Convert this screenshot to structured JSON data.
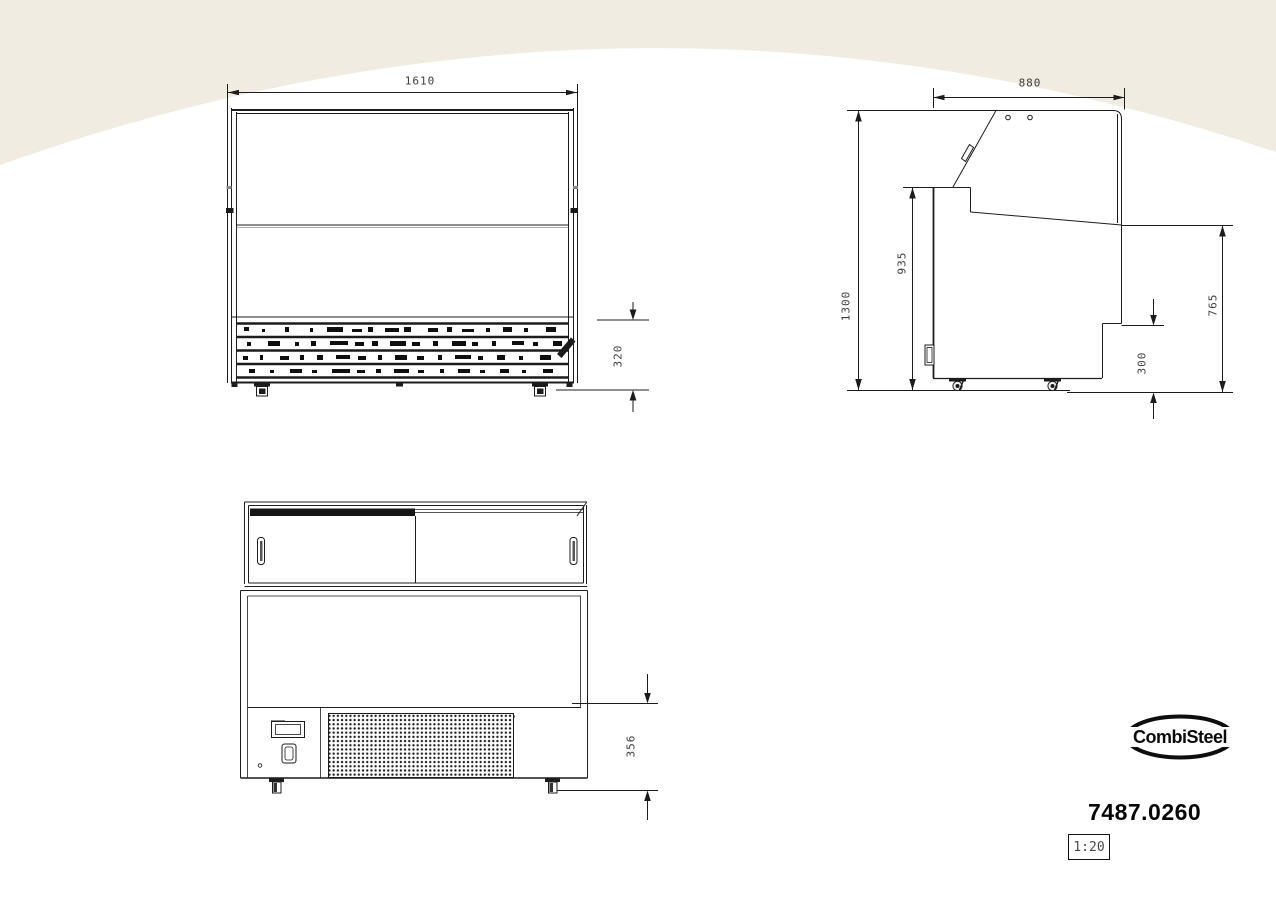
{
  "colors": {
    "backdrop": "#f0ece1",
    "paper": "#ffffff",
    "line": "#1c1c1c",
    "dim_text": "#3d3d3d"
  },
  "drawing": {
    "front_view": {
      "label": "front elevation",
      "dims": {
        "width": "1610",
        "base_height": "320"
      }
    },
    "side_view": {
      "label": "side elevation",
      "dims": {
        "depth": "880",
        "total_height": "1300",
        "worktop_height": "935",
        "display_height": "765",
        "recess_height": "300"
      }
    },
    "rear_view": {
      "label": "rear elevation",
      "dims": {
        "plinth_height": "356"
      }
    }
  },
  "title_block": {
    "brand": "CombiSteel",
    "product_code": "7487.0260",
    "scale": "1:20"
  }
}
